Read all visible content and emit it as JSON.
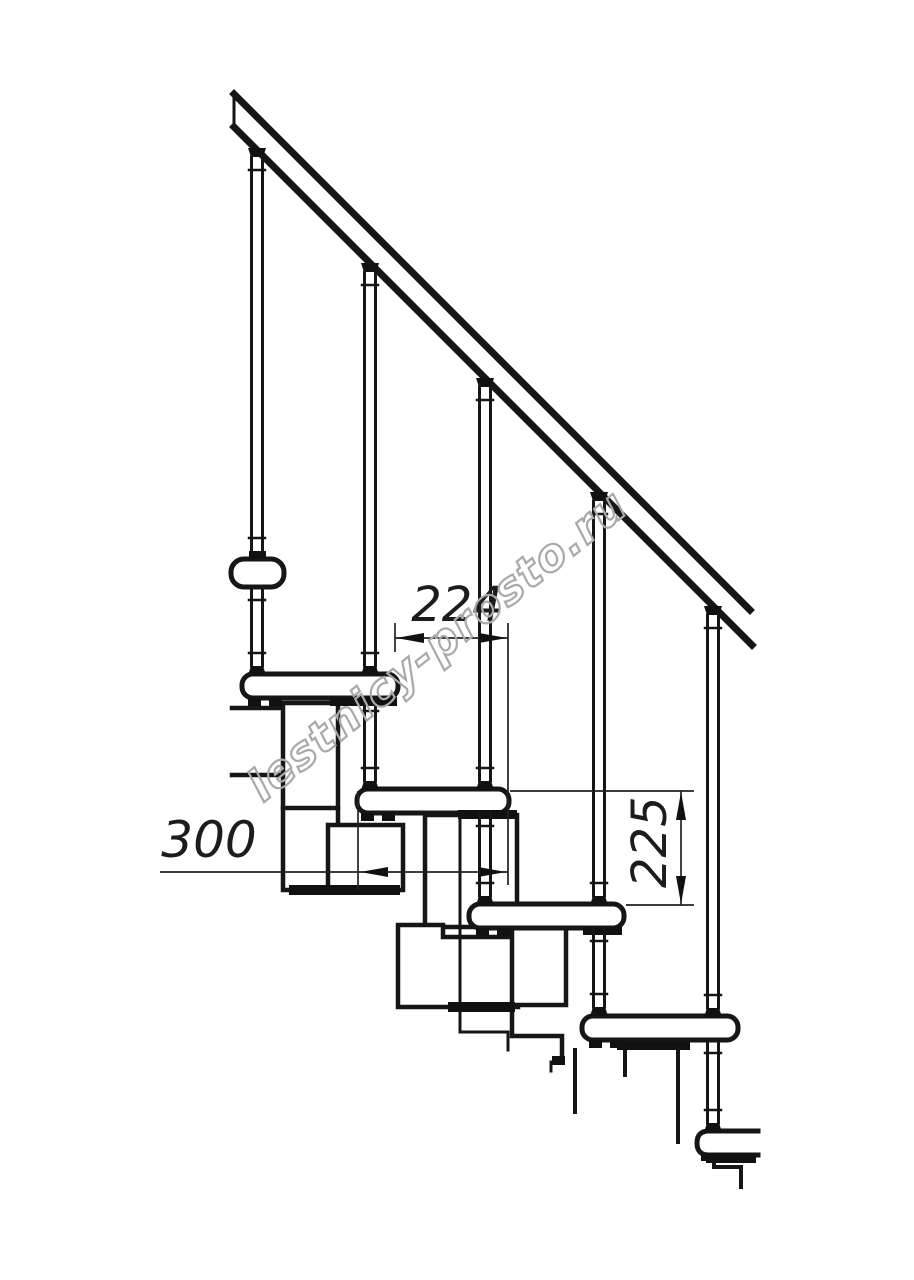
{
  "dimensions": {
    "run": {
      "value": "224",
      "orientation": "horizontal"
    },
    "depth": {
      "value": "300",
      "orientation": "horizontal"
    },
    "rise": {
      "value": "225",
      "orientation": "vertical"
    }
  },
  "watermark": {
    "text": "lestnicy-prosto.ru",
    "color": "#a9a9a9"
  },
  "colors": {
    "line": "#161616",
    "dimension": "#222222",
    "background": "#ffffff"
  }
}
